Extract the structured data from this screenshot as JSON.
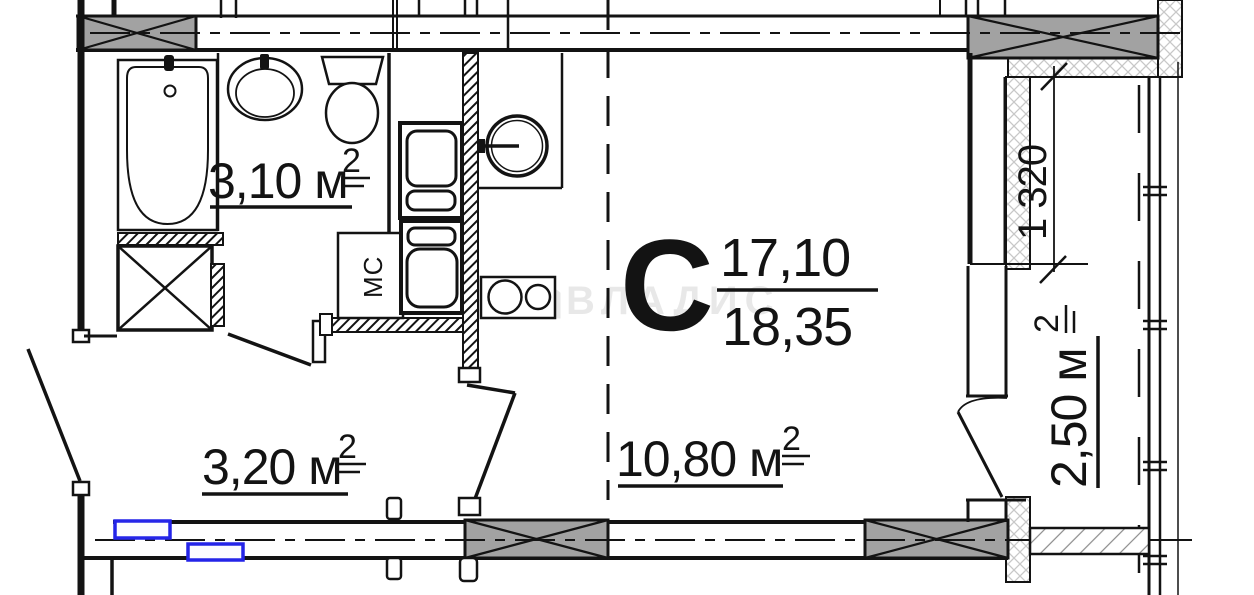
{
  "title": "Studio apartment floor plan",
  "watermark": {
    "brand": "ВЛАДИС"
  },
  "unit": {
    "type_letter": "С",
    "living_area": "17,10",
    "total_area": "18,35"
  },
  "rooms": [
    {
      "id": "bathroom",
      "area": "3,10 м",
      "sup": "2"
    },
    {
      "id": "hallway",
      "area": "3,20 м",
      "sup": "2"
    },
    {
      "id": "main-room",
      "area": "10,80 м",
      "sup": "2"
    },
    {
      "id": "balcony",
      "area": "2,50 м",
      "sup": "2"
    }
  ],
  "labels": {
    "washing_machine": "МС"
  },
  "dimensions": {
    "balcony_width": "1 320"
  },
  "colors": {
    "wall": "#131313",
    "column_fill": "#a2a2a2",
    "radiator_outline": "#2424e8",
    "watermark": "rgba(0,0,0,0.08)"
  }
}
